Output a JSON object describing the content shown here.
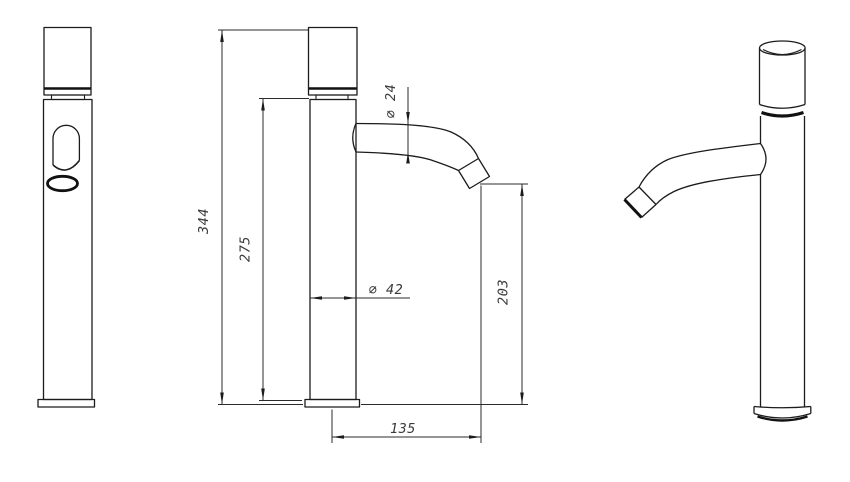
{
  "drawing": {
    "background": "#ffffff",
    "outline_color": "#1c1c1c",
    "dimension_color": "#2b2b2b",
    "text_color": "#3a3a3a",
    "dimensions": {
      "total_height": "344",
      "upper_body_height": "275",
      "spout_diameter": "∅ 24",
      "body_diameter": "∅ 42",
      "spout_outlet_height": "203",
      "spout_reach": "135"
    }
  }
}
